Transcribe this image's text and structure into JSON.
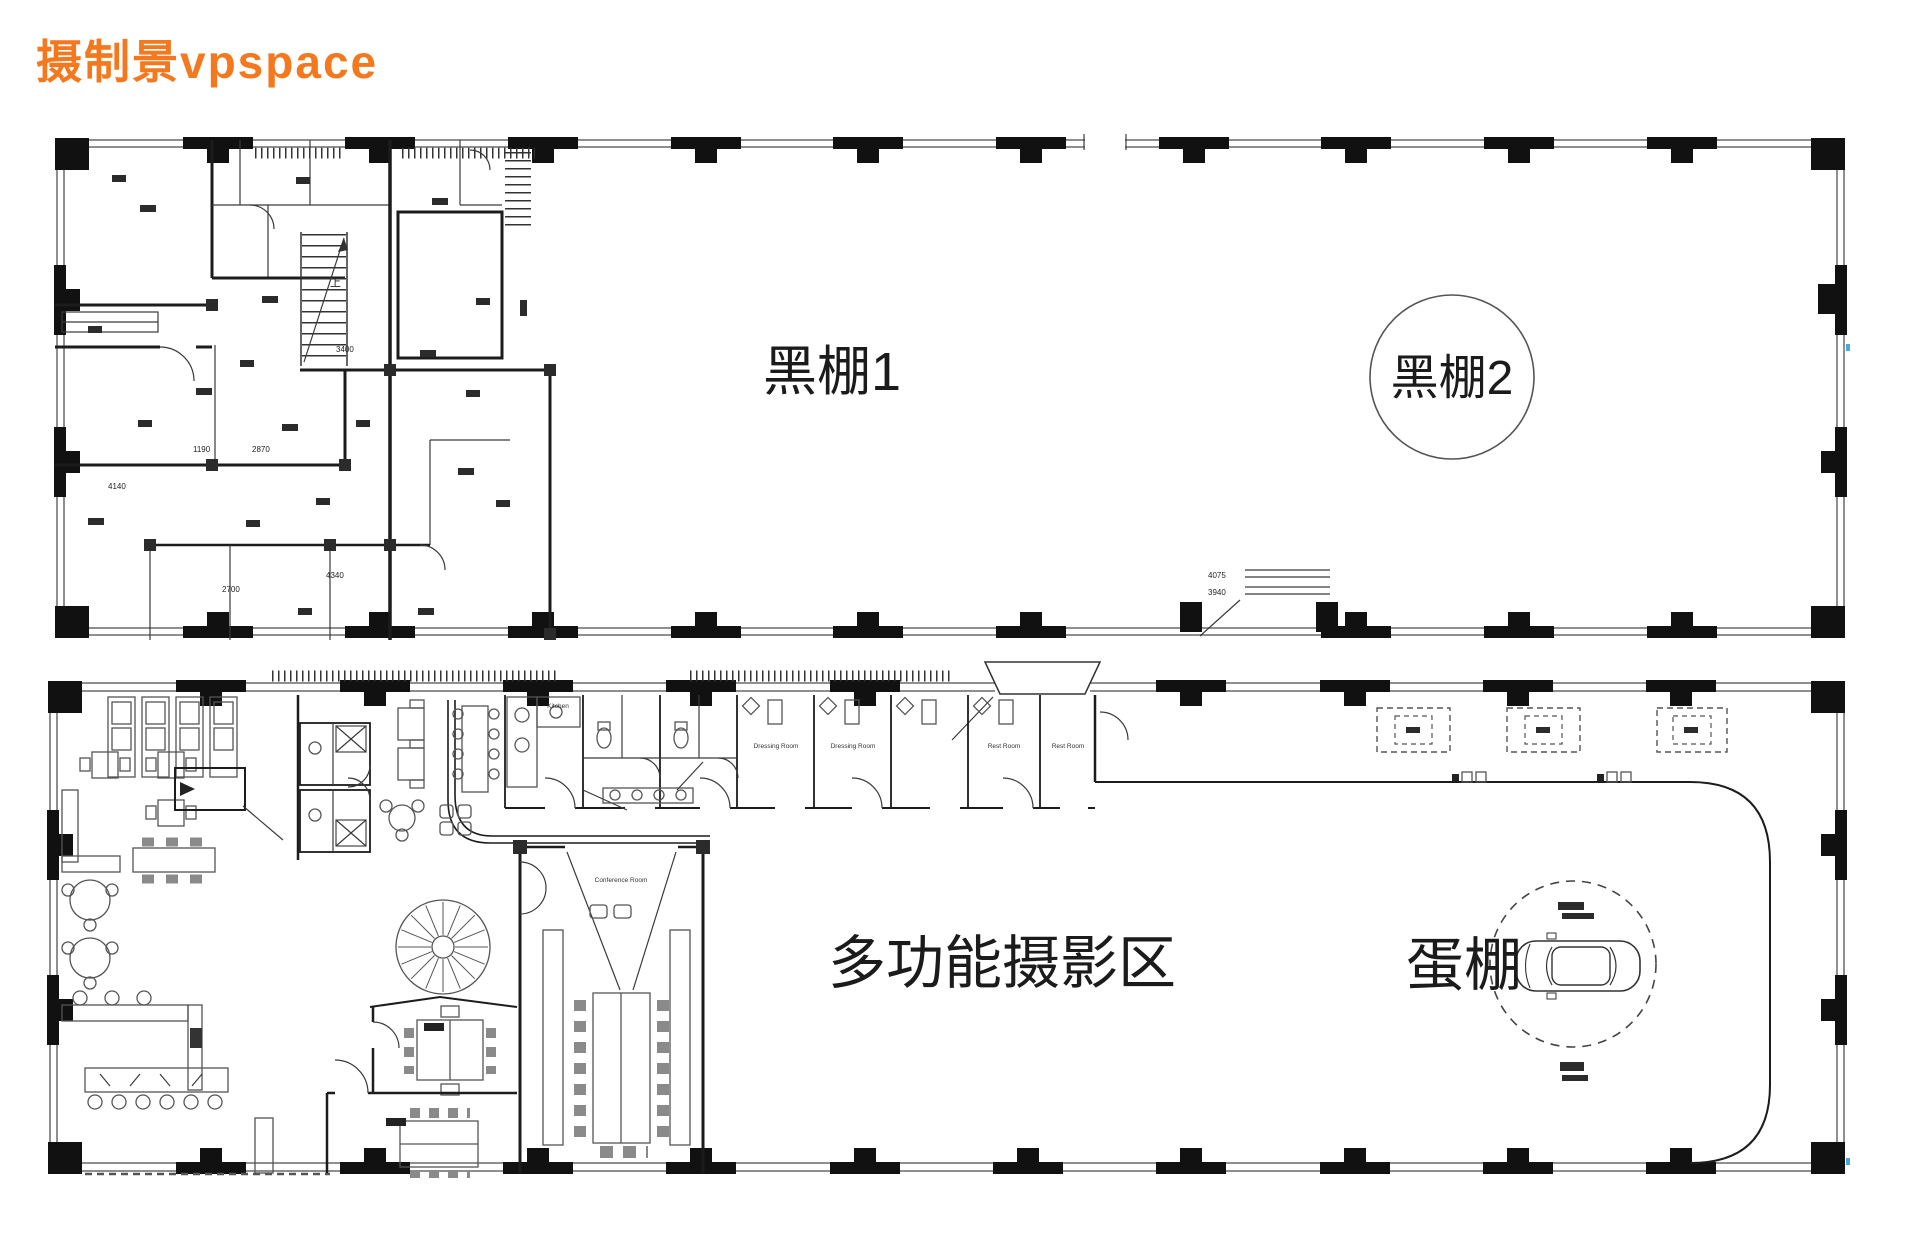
{
  "page": {
    "title": "摄制景vpspace",
    "title_color": "#F4781E",
    "canvas_width": 1920,
    "canvas_height": 1247
  },
  "upper_plan": {
    "studio1_label": "黑棚1",
    "studio2_label": "黑棚2",
    "stair_up_label": "上",
    "dimensions": {
      "d1": "1190",
      "d2": "3400",
      "d3": "4140",
      "d4": "4340",
      "d5": "2700",
      "d6": "2870",
      "entry_width": "4075",
      "entry_depth": "3940"
    }
  },
  "lower_plan": {
    "multi_area_label": "多功能摄影区",
    "egg_studio_label": "蛋棚",
    "kitchen_label": "Kitchen",
    "dressing_room_label": "Dressing Room",
    "rest_room_label": "Rest Room",
    "conference_label": "Conference Room"
  }
}
